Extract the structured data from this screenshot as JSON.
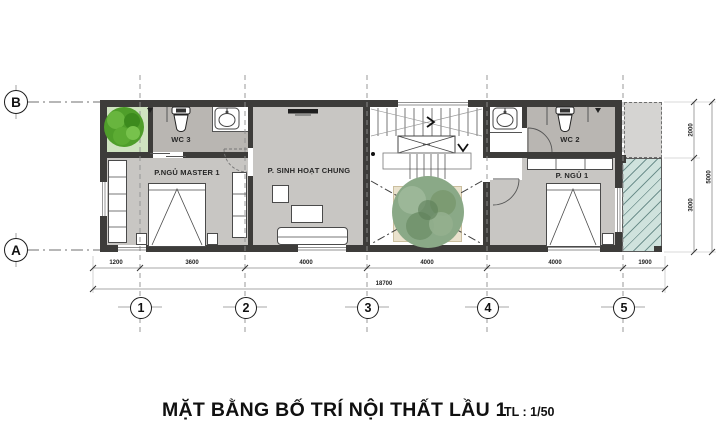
{
  "title": {
    "main": "MẶT BẰNG BỐ TRÍ NỘI THẤT LẦU 1",
    "scale": "TL : 1/50"
  },
  "plan": {
    "rooms": {
      "wc3": "WC 3",
      "master_bedroom": "P.NGỦ MASTER 1",
      "living": "P. SINH HOẠT CHUNG",
      "wc2": "WC 2",
      "bedroom1": "P. NGỦ 1"
    }
  },
  "grid_axes": {
    "letters": [
      "B",
      "A"
    ],
    "numbers": [
      "1",
      "2",
      "3",
      "4",
      "5"
    ]
  },
  "dimensions": {
    "bottom_segments": [
      "1200",
      "3600",
      "4000",
      "4000",
      "4000",
      "1900"
    ],
    "bottom_total": "18700",
    "right_segments": [
      "2000",
      "3000"
    ],
    "right_total": "5000"
  },
  "colors": {
    "wall": "#3d3c3a",
    "room_fill": "#c8c6c3",
    "wc_fill": "#b9b6b2",
    "balcony_fill": "#cfe2dd",
    "slab_fill": "#d5d4d2",
    "planter_fill": "#eae2cd",
    "tree_bright": "#4f9e2a",
    "tree_muted": "#8aa987"
  }
}
